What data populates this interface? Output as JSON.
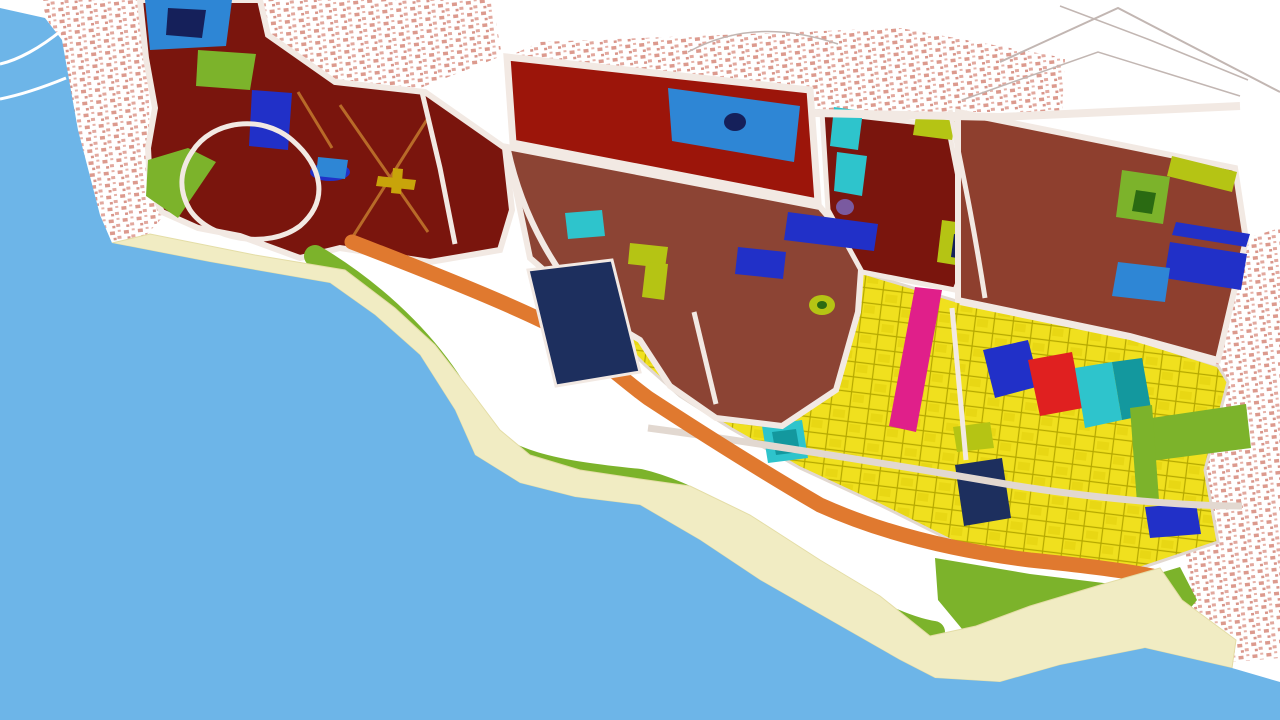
{
  "map": {
    "description": "coastal-city-zoning-master-plan",
    "colors": {
      "land": "#ffffff",
      "water": "#6db5e8",
      "sand": "#f1ecc3",
      "sand_edge": "#e4dda6",
      "green": "#7cb32b",
      "green_dark": "#2a6a12",
      "orange": "#e0792f",
      "yellow": "#f0e01e",
      "maroon": "#7a150d",
      "darkred": "#9c150a",
      "brown": "#8c4434",
      "brown2": "#8e3f2e",
      "navy": "#1d2f5e",
      "navy_deep": "#15205a",
      "royal": "#2130c8",
      "blue": "#2e86d5",
      "cyan": "#2ec4cc",
      "teal_dark": "#13989e",
      "magenta": "#e01f8a",
      "red": "#e02020",
      "olive": "#b5c414",
      "purple": "#7a5aa0",
      "road": "#f2e9e3",
      "road_gray": "#e2d8d0",
      "sketch": "#c2b6b2",
      "marking_yellow": "#c8a40a",
      "orange_road": "#b86a28",
      "pink": "#dc9a8e"
    },
    "layers": [
      {
        "n": "land-base",
        "s": "polygon",
        "p": "0,0 1280,0 1280,720 0,720",
        "f": "land"
      },
      {
        "n": "old-town-west",
        "s": "polygon",
        "p": "40,0 138,0 148,60 150,150 162,218 136,246 112,248 100,215 80,140 58,45",
        "f": "url(#town)"
      },
      {
        "n": "old-town-north-strip",
        "s": "polygon",
        "p": "262,0 492,0 502,56 420,88 335,80 268,33",
        "f": "url(#town)"
      },
      {
        "n": "old-town-north-band",
        "s": "polygon",
        "p": "540,42 900,28 1065,58 1062,112 958,112 810,110 505,58",
        "f": "url(#town)"
      },
      {
        "n": "old-town-east",
        "s": "polygon",
        "p": "1247,238 1280,228 1280,658 1232,662 1198,640 1186,555 1192,460 1208,380 1218,355 1243,242",
        "f": "url(#town)"
      },
      {
        "n": "sketch-line-1",
        "s": "path",
        "p": "M1000,62 L1118,8 L1280,92",
        "f": "none",
        "st": "sketch",
        "sw": 2
      },
      {
        "n": "sketch-line-2",
        "s": "path",
        "p": "M962,100 L1098,52 L1240,96",
        "f": "none",
        "st": "sketch",
        "sw": 1.5
      },
      {
        "n": "sketch-line-3",
        "s": "path",
        "p": "M1060,6 L1150,40 L1248,80",
        "f": "none",
        "st": "sketch",
        "sw": 1.5
      },
      {
        "n": "sketch-line-4",
        "s": "path",
        "p": "M688,52 C740,24 790,28 838,44",
        "f": "none",
        "st": "sketch",
        "sw": 1.5
      },
      {
        "n": "residential-yellow-zone",
        "s": "polygon",
        "p": "615,315 640,300 700,287 740,280 860,272 960,302 1130,338 1218,366 1228,382 1205,470 1218,542 1120,575 1040,562 960,545 880,505 800,468 730,428 680,396 645,365 620,340",
        "f": "url(#ygrid)",
        "st": "road_gray",
        "sw": 3
      },
      {
        "n": "magenta-strip-parcel",
        "s": "polygon",
        "p": "915,287 942,290 916,432 889,426",
        "f": "magenta"
      },
      {
        "n": "navy-parcel-center",
        "s": "polygon",
        "p": "983,350 1028,340 1040,386 995,398",
        "f": "royal"
      },
      {
        "n": "red-parcel",
        "s": "polygon",
        "p": "1028,360 1072,352 1083,408 1040,416",
        "f": "red"
      },
      {
        "n": "cyan-parcel-a",
        "s": "polygon",
        "p": "1075,368 1112,362 1122,420 1085,428",
        "f": "cyan"
      },
      {
        "n": "cyan-parcel-b",
        "s": "polygon",
        "p": "1112,362 1142,358 1152,414 1122,420",
        "f": "teal_dark"
      },
      {
        "n": "navy-parcel-south",
        "s": "polygon",
        "p": "955,465 1002,458 1011,518 964,526",
        "f": "navy"
      },
      {
        "n": "teal-patch-outer",
        "s": "polygon",
        "p": "762,426 802,420 808,458 768,463",
        "f": "cyan"
      },
      {
        "n": "teal-patch-inner",
        "s": "polygon",
        "p": "772,432 796,429 800,452 776,455",
        "f": "teal_dark"
      },
      {
        "n": "green-strip-east-a",
        "s": "polygon",
        "p": "1138,420 1246,404 1251,448 1143,462",
        "f": "green"
      },
      {
        "n": "green-strip-east-b",
        "s": "polygon",
        "p": "1130,408 1152,405 1159,500 1137,503",
        "f": "green"
      },
      {
        "n": "olive-parcel-yellowzone",
        "s": "polygon",
        "p": "953,427 990,422 994,448 957,452",
        "f": "olive"
      },
      {
        "n": "blue-parcel-southeast",
        "s": "polygon",
        "p": "1145,507 1196,503 1201,534 1150,538",
        "f": "royal"
      },
      {
        "n": "maroon-district-west",
        "s": "polygon",
        "p": "140,0 260,0 268,35 335,82 425,92 505,148 512,210 500,250 430,262 340,248 300,258 240,236 198,228 162,212 150,188 148,148 155,108 146,58",
        "f": "maroon",
        "st": "road",
        "sw": 6
      },
      {
        "n": "blue-parcel-top",
        "s": "polygon",
        "p": "145,0 232,0 226,46 150,50",
        "f": "blue"
      },
      {
        "n": "blue-parcel-top-core",
        "s": "polygon",
        "p": "168,8 206,10 202,38 166,35",
        "f": "navy_deep"
      },
      {
        "n": "green-parcel-nw",
        "s": "polygon",
        "p": "198,50 256,54 250,90 196,86",
        "f": "green"
      },
      {
        "n": "green-coast-strip-nw",
        "s": "polygon",
        "p": "148,160 188,148 216,162 178,218 146,196",
        "f": "green"
      },
      {
        "n": "royal-parcel-nw",
        "s": "polygon",
        "p": "252,90 292,93 288,150 249,146",
        "f": "royal"
      },
      {
        "n": "blue-oval-parcel",
        "s": "ellipse",
        "cx": 330,
        "cy": 172,
        "rx": 20,
        "ry": 9,
        "f": "royal"
      },
      {
        "n": "blue-parcel-small-b",
        "s": "polygon",
        "p": "318,157 348,160 345,179 316,176",
        "f": "blue"
      },
      {
        "n": "loop-road-west",
        "s": "path",
        "p": "M192,152 C212,120 262,114 292,140 C322,166 330,200 300,226 C268,250 210,240 190,210 C178,190 180,170 192,152 Z",
        "f": "none",
        "st": "road",
        "sw": 5
      },
      {
        "n": "internal-road-maroon-1",
        "s": "path",
        "p": "M340,105 L428,232",
        "f": "none",
        "st": "orange_road",
        "sw": 3
      },
      {
        "n": "internal-road-maroon-2",
        "s": "path",
        "p": "M428,118 L352,238",
        "f": "none",
        "st": "orange_road",
        "sw": 3
      },
      {
        "n": "internal-road-maroon-3",
        "s": "path",
        "p": "M298,92 L332,148",
        "f": "none",
        "st": "orange_road",
        "sw": 3
      },
      {
        "n": "yellow-marking-h",
        "s": "polygon",
        "p": "378,176 416,180 414,190 376,186",
        "f": "marking_yellow"
      },
      {
        "n": "yellow-marking-v",
        "s": "polygon",
        "p": "393,168 403,169 401,194 391,193",
        "f": "marking_yellow"
      },
      {
        "n": "road-maroon-split",
        "s": "path",
        "p": "M422,92 L440,168 L455,244",
        "f": "none",
        "st": "road",
        "sw": 5
      },
      {
        "n": "darkred-superblock",
        "s": "polygon",
        "p": "507,57 810,90 818,202 513,143",
        "f": "darkred",
        "st": "road",
        "sw": 7
      },
      {
        "n": "blue-parcel-superblock",
        "s": "polygon",
        "p": "668,88 800,106 794,162 672,141",
        "f": "blue"
      },
      {
        "n": "navy-dot-superblock",
        "s": "ellipse",
        "cx": 735,
        "cy": 122,
        "rx": 11,
        "ry": 9,
        "f": "navy_deep"
      },
      {
        "n": "brown-district-central",
        "s": "polygon",
        "p": "507,147 820,207 862,256 858,312 836,390 782,426 716,418 670,386 640,340 590,310 530,258",
        "f": "brown",
        "st": "road",
        "sw": 6
      },
      {
        "n": "cyan-parcel-central",
        "s": "polygon",
        "p": "565,213 602,210 605,236 568,239",
        "f": "cyan"
      },
      {
        "n": "olive-L-a",
        "s": "polygon",
        "p": "630,243 668,247 665,268 628,264",
        "f": "olive"
      },
      {
        "n": "olive-L-b",
        "s": "polygon",
        "p": "646,262 668,264 664,300 642,297",
        "f": "olive"
      },
      {
        "n": "royal-parcel-central",
        "s": "polygon",
        "p": "738,247 786,252 783,279 735,274",
        "f": "royal"
      },
      {
        "n": "olive-dot-central",
        "s": "ellipse",
        "cx": 822,
        "cy": 305,
        "rx": 13,
        "ry": 10,
        "f": "olive"
      },
      {
        "n": "olive-dot-core",
        "s": "ellipse",
        "cx": 822,
        "cy": 305,
        "rx": 5,
        "ry": 4,
        "f": "green_dark"
      },
      {
        "n": "maroon-district-mid",
        "s": "polygon",
        "p": "822,112 948,126 972,248 955,290 862,272 828,210",
        "f": "maroon",
        "st": "road",
        "sw": 5
      },
      {
        "n": "cyan-strip-mid-a",
        "s": "polygon",
        "p": "834,107 863,111 858,150 830,146",
        "f": "cyan"
      },
      {
        "n": "cyan-strip-mid-b",
        "s": "polygon",
        "p": "837,152 867,156 862,196 834,191",
        "f": "cyan"
      },
      {
        "n": "purple-dot-mid",
        "s": "ellipse",
        "cx": 845,
        "cy": 207,
        "rx": 9,
        "ry": 8,
        "f": "purple"
      },
      {
        "n": "royal-strip-mid",
        "s": "polygon",
        "p": "788,212 878,224 874,251 784,240",
        "f": "royal"
      },
      {
        "n": "olive-parcel-mid",
        "s": "polygon",
        "p": "916,116 956,121 952,140 913,135",
        "f": "olive"
      },
      {
        "n": "green-square-mid",
        "s": "polygon",
        "p": "942,220 992,227 986,270 937,262",
        "f": "olive"
      },
      {
        "n": "navy-core-mid",
        "s": "polygon",
        "p": "954,234 979,238 975,261 951,257",
        "f": "navy_deep"
      },
      {
        "n": "brown-district-east",
        "s": "polygon",
        "p": "958,112 1235,168 1246,240 1218,360 1130,336 958,300",
        "f": "brown2",
        "st": "road",
        "sw": 6
      },
      {
        "n": "green-square-east",
        "s": "polygon",
        "p": "1122,170 1170,177 1163,224 1116,217",
        "f": "green"
      },
      {
        "n": "green-square-east-core",
        "s": "polygon",
        "p": "1136,190 1156,193 1152,214 1132,211",
        "f": "green_dark"
      },
      {
        "n": "olive-strip-east",
        "s": "polygon",
        "p": "1172,156 1237,172 1232,192 1167,176",
        "f": "olive"
      },
      {
        "n": "blue-strip-east",
        "s": "polygon",
        "p": "1176,222 1250,234 1246,247 1172,235",
        "f": "royal"
      },
      {
        "n": "royal-parcel-east",
        "s": "polygon",
        "p": "1170,242 1247,254 1241,290 1164,278",
        "f": "royal"
      },
      {
        "n": "blue-parcel-east",
        "s": "polygon",
        "p": "1118,262 1170,268 1165,302 1112,296",
        "f": "blue"
      },
      {
        "n": "road-central-west",
        "s": "path",
        "p": "M508,150 C522,215 556,278 602,320",
        "f": "none",
        "st": "road",
        "sw": 6
      },
      {
        "n": "road-north-artery",
        "s": "path",
        "p": "M815,113 L1000,117 L1240,106",
        "f": "none",
        "st": "road",
        "sw": 8
      },
      {
        "n": "road-coastal-artery",
        "s": "path",
        "p": "M648,428 C760,443 900,466 1000,483 C1080,497 1180,506 1242,506",
        "f": "none",
        "st": "road_gray",
        "sw": 7
      },
      {
        "n": "road-yellow-a",
        "s": "path",
        "p": "M694,312 L716,404",
        "f": "none",
        "st": "road",
        "sw": 5
      },
      {
        "n": "road-yellow-b",
        "s": "path",
        "p": "M952,308 L966,460",
        "f": "none",
        "st": "road",
        "sw": 5
      },
      {
        "n": "road-mid-east",
        "s": "path",
        "p": "M950,110 C962,170 972,215 985,298",
        "f": "none",
        "st": "road",
        "sw": 5
      },
      {
        "n": "road-yellow-north-edge",
        "s": "path",
        "p": "M960,303 L1130,338 L1216,364",
        "f": "none",
        "st": "road",
        "sw": 4
      },
      {
        "n": "orange-buffer-band",
        "s": "path",
        "p": "M352,242 C430,272 500,300 545,322 C592,350 618,376 648,398 C700,432 760,470 820,505 C880,532 950,550 1030,560 C1090,566 1132,572 1152,576",
        "f": "none",
        "st": "orange",
        "sw": 15,
        "lc": "round"
      },
      {
        "n": "green-belt-band",
        "s": "path",
        "p": "M315,256 C380,295 440,352 472,420 C495,462 560,472 640,480 C700,494 760,538 830,585 C868,610 908,628 934,632",
        "f": "none",
        "st": "green",
        "sw": 22,
        "lc": "round"
      },
      {
        "n": "green-zone-southeast",
        "s": "polygon",
        "p": "935,558 1030,574 1120,585 1180,567 1197,600 1166,638 1106,656 1030,659 972,641 938,600",
        "f": "green"
      },
      {
        "n": "beach-sand",
        "s": "polygon",
        "p": "112,243 210,262 330,283 375,315 420,355 455,410 475,455 520,483 575,497 640,505 700,540 760,580 830,620 900,660 935,678 1000,682 1060,665 1145,648 1232,668 1236,640 1182,600 1160,568 1100,585 1030,606 976,626 930,636 880,596 820,560 750,515 690,486 640,479 580,470 530,455 500,430 470,390 435,345 395,308 345,270 255,255 150,234",
        "f": "sand",
        "st": "sand_edge",
        "sw": 1
      },
      {
        "n": "sea-water",
        "s": "polygon",
        "p": "0,8 45,18 62,40 78,130 100,215 112,243 210,262 330,283 375,315 420,355 455,410 475,455 520,483 575,497 640,505 700,540 760,580 830,620 900,660 935,678 1000,682 1060,665 1145,648 1232,668 1280,682 1280,720 0,720",
        "f": "water"
      },
      {
        "n": "harbor-pier-1",
        "s": "path",
        "p": "M62,30 C40,48 18,60 0,64",
        "f": "none",
        "st": "land",
        "sw": 3
      },
      {
        "n": "harbor-pier-2",
        "s": "path",
        "p": "M66,78 C44,87 20,95 0,99",
        "f": "none",
        "st": "land",
        "sw": 3
      },
      {
        "n": "navy-superparcel-coast",
        "s": "polygon",
        "p": "528,270 612,260 640,372 556,386",
        "f": "navy",
        "st": "road",
        "sw": 3
      }
    ]
  }
}
